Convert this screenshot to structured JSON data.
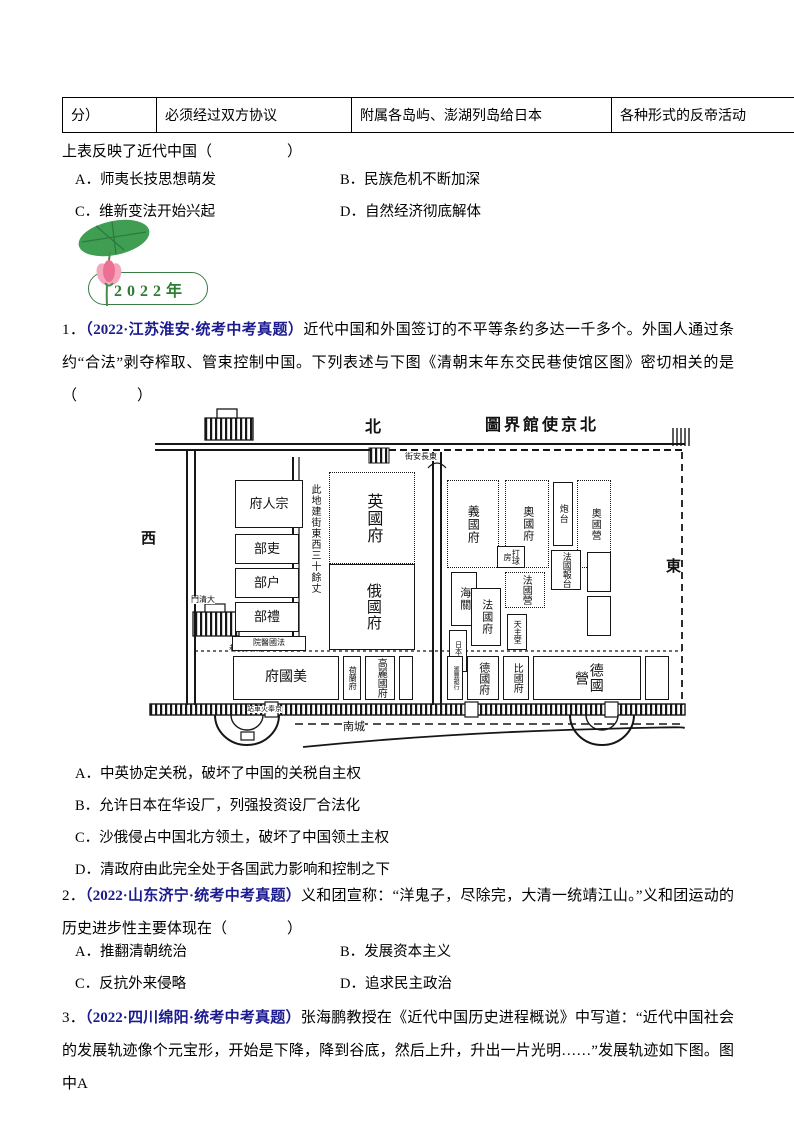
{
  "colors": {
    "source_blue": "#1b1b8f",
    "badge_green": "#2e7d32",
    "leaf_green": "#3f9e52",
    "flower_pink": "#f07f9e"
  },
  "table": {
    "cells": [
      "分）",
      "必须经过双方协议",
      "附属各岛屿、澎湖列岛给日本",
      "各种形式的反帝活动"
    ]
  },
  "q0": {
    "stem": "上表反映了近代中国（　　　　　）",
    "options": [
      "A．师夷长技思想萌发",
      "B．民族危机不断加深",
      "C．维新变法开始兴起",
      "D．自然经济彻底解体"
    ]
  },
  "badge": {
    "year": "2022年"
  },
  "q1": {
    "number": "1．",
    "source": "（2022·江苏淮安·统考中考真题）",
    "stem": "近代中国和外国签订的不平等条约多达一千多个。外国人通过条约“合法”剥夺榨取、管束控制中国。下列表述与下图《清朝末年东交民巷使馆区图》密切相关的是（　　　　）",
    "options": [
      "A．中英协定关税，破坏了中国的关税自主权",
      "B．允许日本在华设厂，列强投资设厂合法化",
      "C．沙俄侵占中国北方领土，破坏了中国领土主权",
      "D．清政府由此完全处于各国武力影响和控制之下"
    ]
  },
  "q2": {
    "number": "2．",
    "source": "（2022·山东济宁·统考中考真题）",
    "stem": "义和团宣称：“洋鬼子，尽除完，大清一统靖江山。”义和团运动的历史进步性主要体现在（　　　　）",
    "options": [
      "A．推翻清朝统治",
      "B．发展资本主义",
      "C．反抗外来侵略",
      "D．追求民主政治"
    ]
  },
  "q3": {
    "number": "3．",
    "source": "（2022·四川绵阳·统考中考真题）",
    "stem": "张海鹏教授在《近代中国历史进程概说》中写道：“近代中国社会的发展轨迹像个元宝形，开始是下降，降到谷底，然后上升，升出一片光明……”发展轨迹如下图。图中A"
  },
  "map": {
    "title": "圖界館使京北",
    "compass": {
      "north": "北",
      "west": "西",
      "east": "東",
      "south": "南城"
    },
    "streets": {
      "dongchangan": "街安長東",
      "dongjiaominxiang": "巷民交東",
      "railway_station": "站車火奉京",
      "daqingmen": "門清大"
    },
    "note": "此地建街東西三十餘丈",
    "buildings": {
      "zongrenfu": "府人宗",
      "boards_li": "部吏",
      "boards_hu": "部户",
      "boards_rites": "部禮",
      "french_hospital": "院醫國法",
      "british_legation": "英國府",
      "russian_legation": "俄國府",
      "italian_legation": "義國府",
      "austrian_legation": "奧國府",
      "battery": "炮台",
      "austrian_barracks": "奧國營",
      "customs": "海關",
      "japanese_legation": "日本府",
      "french_legation": "法國府",
      "french_barracks": "法國營",
      "catholic_church": "天主堂",
      "ball_house": "打球房",
      "french_telegraph": "法國報台",
      "american_legation": "府國美",
      "dutch_legation": "荷蘭府",
      "korean_legation": "高麗國府",
      "hsbc_bank": "滙豐銀行",
      "german_legation": "德國府",
      "belgian_legation": "比國府",
      "german_barracks": "德國營"
    }
  }
}
